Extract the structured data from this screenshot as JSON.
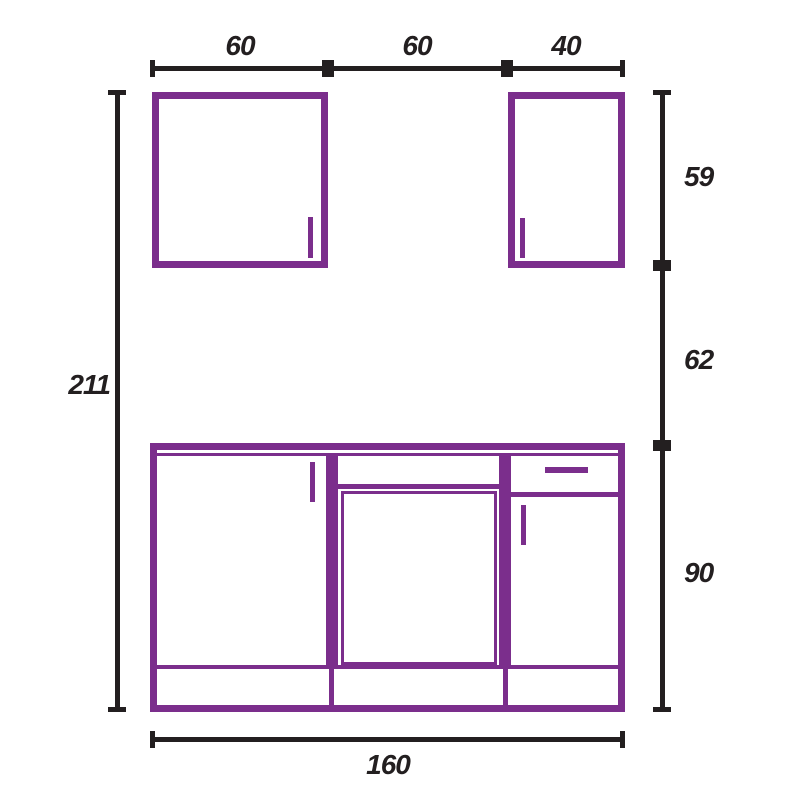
{
  "diagram": {
    "type": "kitchen-cabinet-elevation-drawing",
    "colors": {
      "cabinet_outline": "#7B2E8C",
      "dimension_lines": "#231F20",
      "background": "#FFFFFF"
    },
    "dims": {
      "top_segment_1": "60",
      "top_segment_2": "60",
      "top_segment_3": "40",
      "left_total": "211",
      "right_segment_1": "59",
      "right_segment_2": "62",
      "right_segment_3": "90",
      "bottom_total": "160"
    },
    "components": {
      "wall_cabinet_left": "wall cabinet with right-side door handle",
      "wall_cabinet_right": "wall cabinet with left-side door handle",
      "base_unit": "base run: door section, sink/false-front section, drawer-and-door section, plinth"
    }
  }
}
